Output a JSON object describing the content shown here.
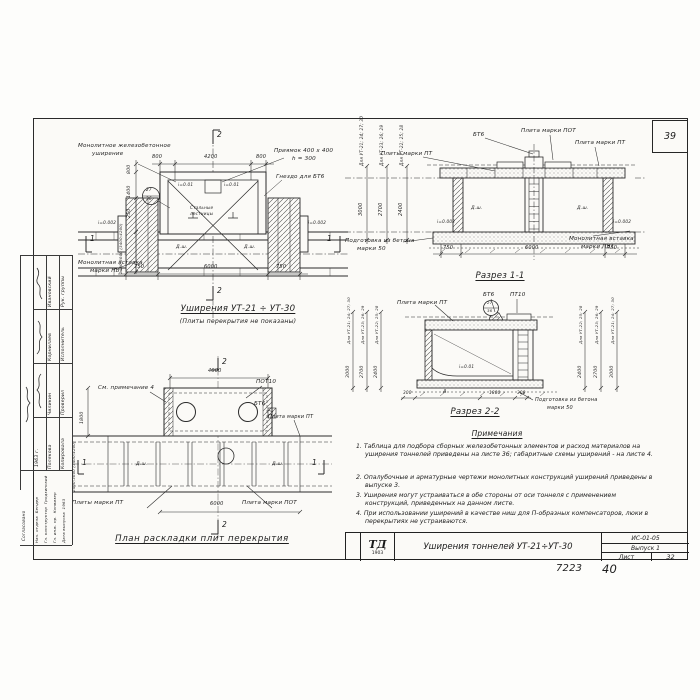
{
  "page": {
    "corner_number": "39",
    "footer_code": "7223",
    "footer_page": "40"
  },
  "sidebar": {
    "group1": [
      {
        "role": "Рук. группы",
        "name": "Ивановский"
      },
      {
        "role": "Исполнитель",
        "name": "Корнилаев"
      },
      {
        "role": "Проверил",
        "name": "Чиликин"
      },
      {
        "role": "Копировала",
        "name": "Полякова"
      }
    ],
    "year": "1963 г.",
    "agreed": "Согласовано",
    "group2": [
      {
        "role": "Нач. отдела",
        "name": "Бендер"
      },
      {
        "role": "Гл. конструктор",
        "name": "Гродзинский"
      },
      {
        "role": "Гл. инж. пр.",
        "name": "Конвизер"
      },
      {
        "role": "Дата выпуска",
        "name": "1963"
      }
    ]
  },
  "fig1": {
    "title": "Уширения УТ-21 ÷ УТ-30",
    "subtitle": "(Плиты перекрытия не показаны)",
    "label_widening_1": "Монолитное железобетонное",
    "label_widening_2": "уширение",
    "label_pit_1": "Приямок 400 х 400",
    "label_pit_2": "h = 300",
    "label_socket": "Гнездо для БТ6",
    "label_ladders_1": "Стальные",
    "label_ladders_2": "лестницы",
    "label_insert_1": "Монолитная вставка",
    "label_insert_2": "марки ПВТ",
    "detail_top": "27",
    "detail_bottom": "36",
    "dim_top": [
      "800",
      "4200",
      "800"
    ],
    "dim_bottom": [
      "750",
      "6000",
      "750"
    ],
    "dim_left": [
      "800",
      "1400",
      "250"
    ],
    "dim_left_rotated": "2400;3000 (3400;4200)",
    "slope_small": "i=0.01",
    "slope_edge": "i=0.002",
    "dsh": "Д.ш.",
    "marker1": "1",
    "marker2": "2"
  },
  "fig2": {
    "title": "Разрез 1-1",
    "label_pt_plates": "Плиты марки ПТ",
    "label_bt6": "БТ6",
    "label_pot": "Плита марки ПОТ",
    "label_pt": "Плита марки ПТ",
    "label_prep_1": "Подготовка из бетона",
    "label_prep_2": "марки 50",
    "label_insert_1": "Монолитная вставка",
    "label_insert_2": "марки ПВТ",
    "dims_left": [
      {
        "label": "Для УТ-21; 24; 27; 30",
        "value": "3000"
      },
      {
        "label": "Для УТ-23; 26; 29",
        "value": "2700"
      },
      {
        "label": "Для УТ-22; 25; 28",
        "value": "2400"
      }
    ],
    "dim_bottom": [
      "750",
      "6000",
      "750"
    ],
    "slope": "i=0.002",
    "dsh": "Д.ш."
  },
  "fig3": {
    "title": "Разрез 2-2",
    "label_pt": "Плита марки ПТ",
    "label_bt6": "БТ6",
    "label_pt10": "ПТ10",
    "detail_top": "27",
    "detail_bottom": "36",
    "slope": "i=0.01",
    "label_prep_1": "Подготовка из бетона",
    "label_prep_2": "марки 50",
    "dims_left": [
      {
        "label": "Для УТ-21; 24; 27; 30",
        "value": "3000"
      },
      {
        "label": "Для УТ-23; 26; 29",
        "value": "2700"
      },
      {
        "label": "Для УТ-22; 25; 28",
        "value": "2400"
      }
    ],
    "dims_right": [
      {
        "label": "Для УТ-22; 25; 28",
        "value": "2400"
      },
      {
        "label": "Для УТ-23; 26; 29",
        "value": "2700"
      },
      {
        "label": "Для УТ-21; 24; 27; 30",
        "value": "3000"
      }
    ],
    "dim_bottom": [
      "300",
      "А",
      "1800",
      "300"
    ]
  },
  "fig4": {
    "title": "План раскладки плит перекрытия",
    "label_note": "См. примечание 4",
    "label_pot10": "ПОТ10",
    "label_bt6": "БТ6",
    "label_pt": "Плита марки ПТ",
    "label_pt_plates": "Плиты марки ПТ",
    "label_pot": "Плита марки ПОТ",
    "dim_top": "4000",
    "dim_left": "1800",
    "dim_left_rotated": "2400;3000 (3400;4200)",
    "dim_bottom": "6000",
    "dsh": "Д.ш.",
    "marker1": "1",
    "marker2": "2"
  },
  "notes": {
    "header": "Примечания",
    "items": [
      "1. Таблица для подбора сборных железобетонных элементов и расход материалов на уширения тоннелей приведены на листе 36; габаритные схемы уширений - на листе 4.",
      "2. Опалубочные и арматурные чертежи монолитных конструкций уширений приведены в выпуске 3.",
      "3. Уширения могут устраиваться в обе стороны от оси тоннеля с применением конструкций, приведенных на данном листе.",
      "4. При использовании уширений в качестве ниш для П-образных компенсаторов, люки в перекрытиях не устраиваются."
    ]
  },
  "titleblock": {
    "logo_name": "ТД",
    "logo_year": "1903",
    "title": "Уширения тоннелей УТ-21÷УТ-30",
    "doc_code": "ИС-01-05",
    "issue": "Выпуск 1",
    "sheet_label": "Лист",
    "sheet_number": "32"
  }
}
